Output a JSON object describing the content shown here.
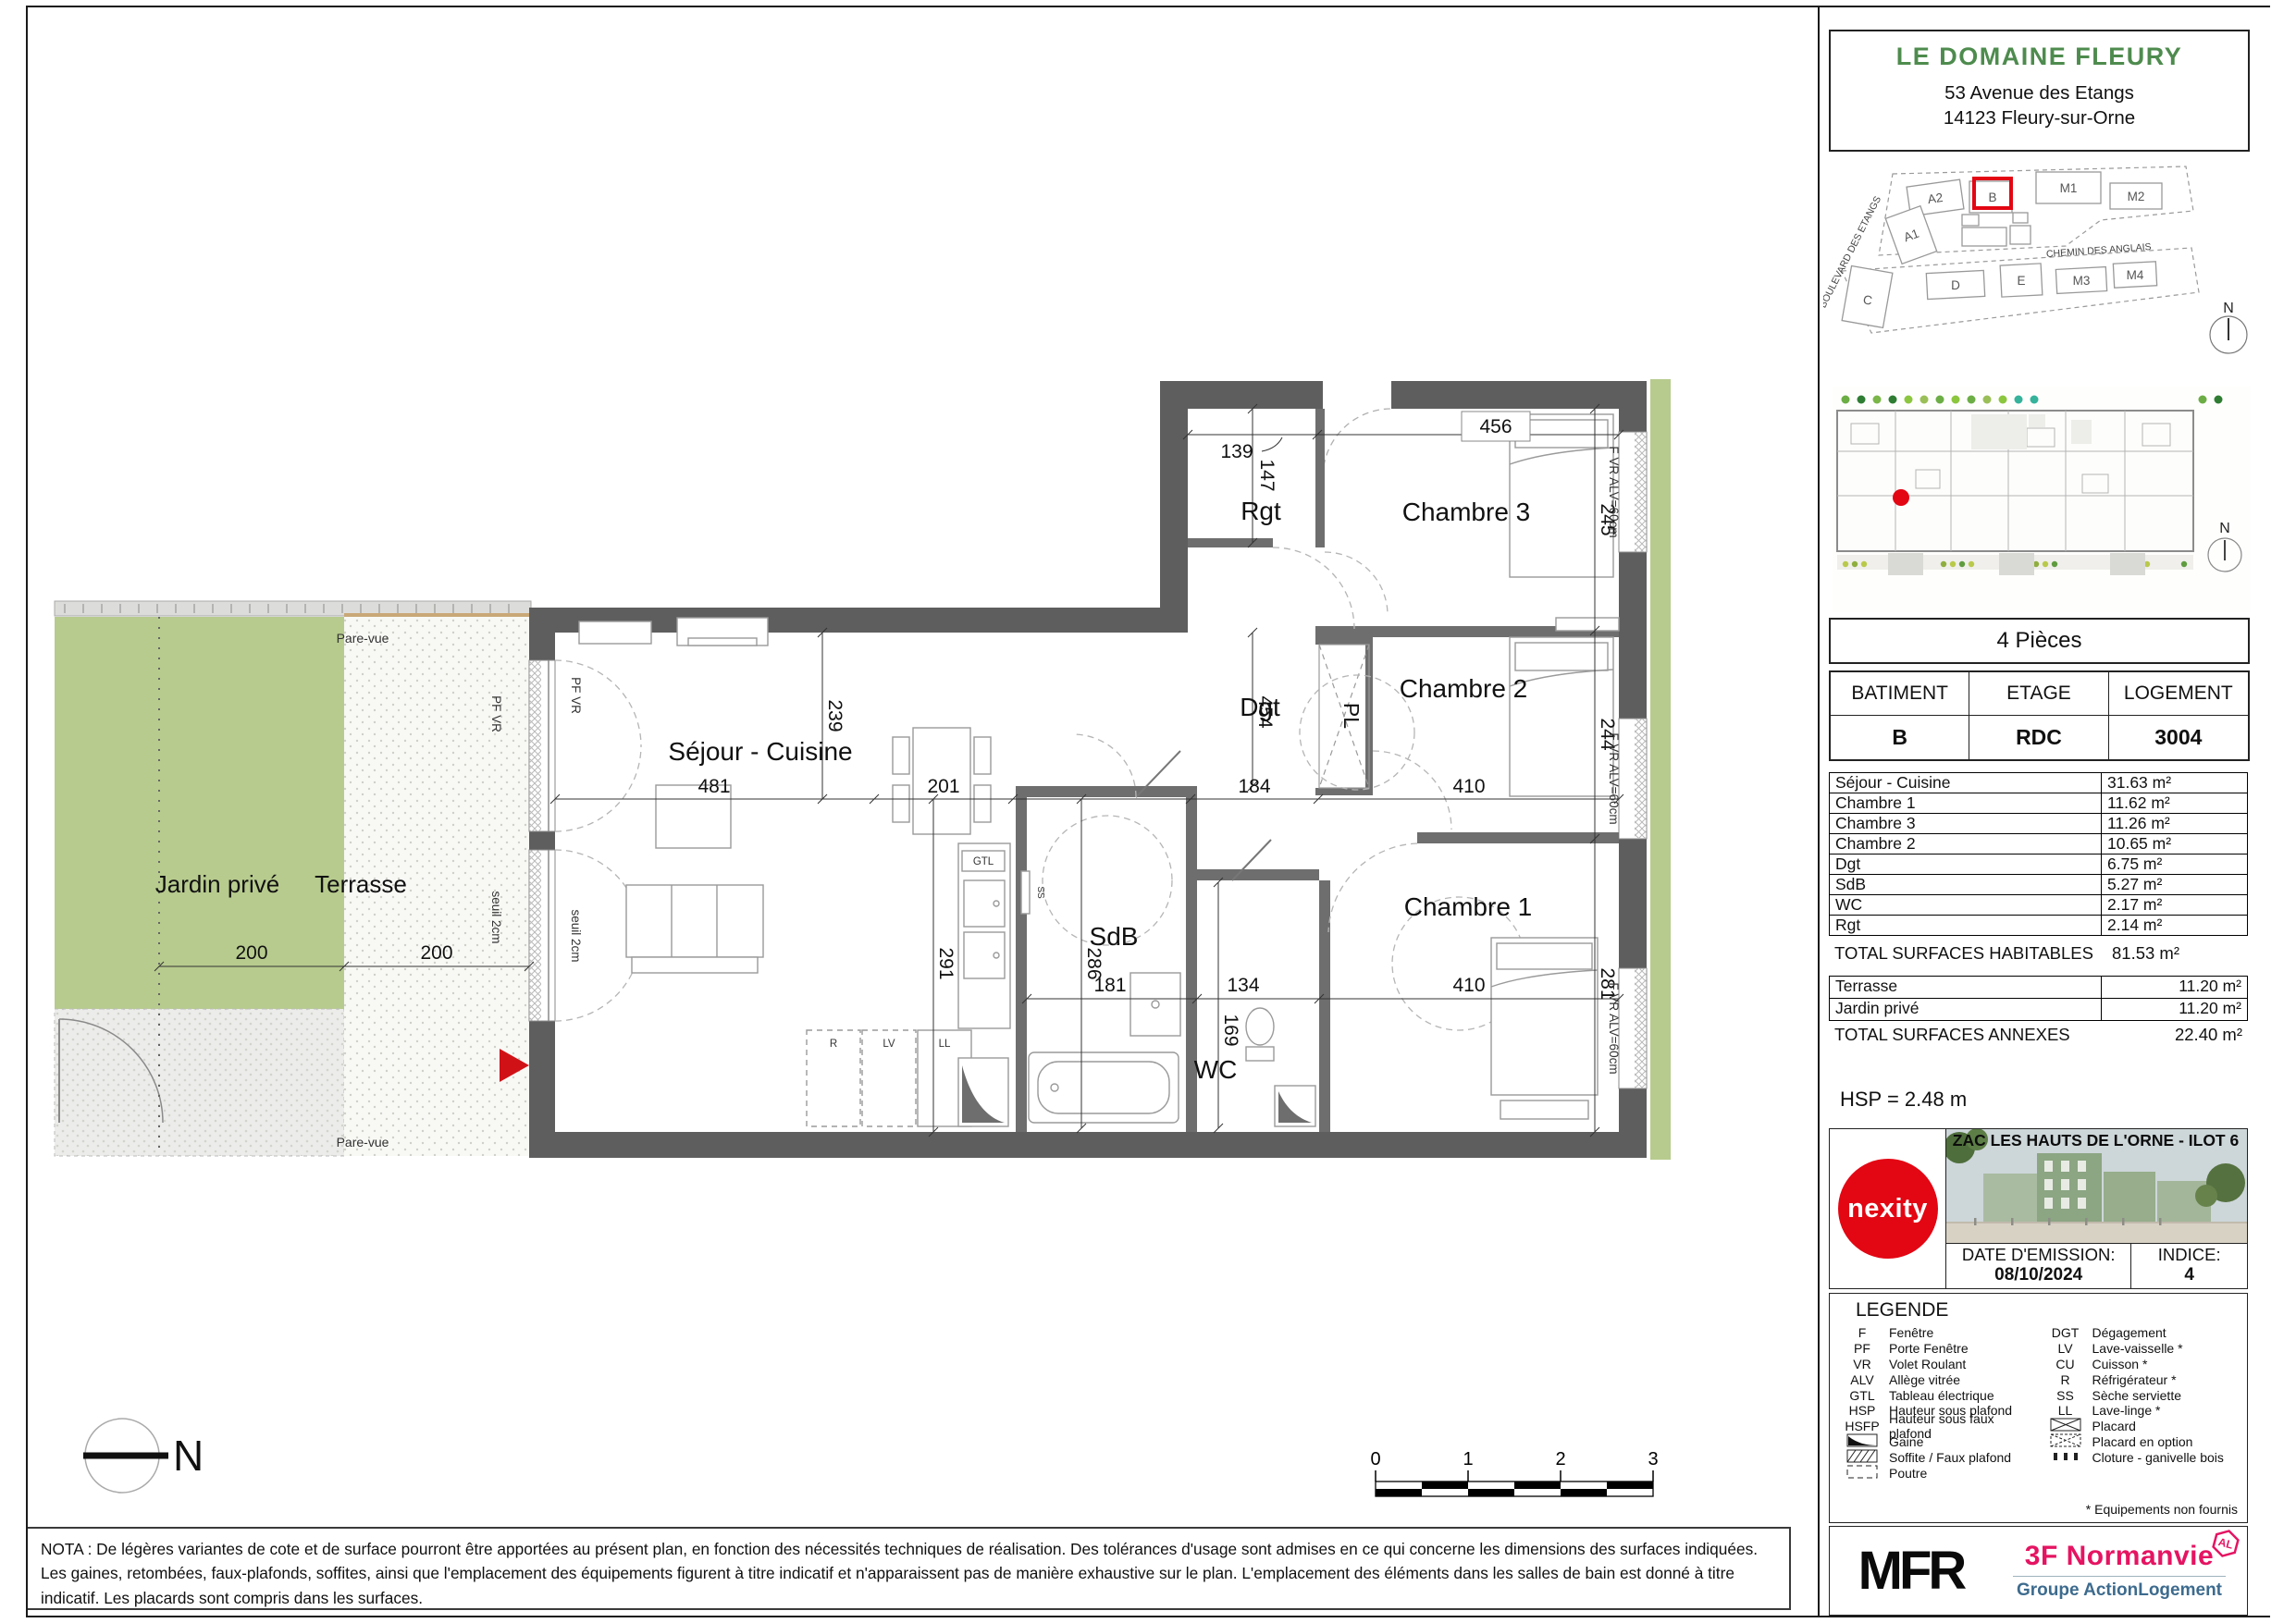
{
  "colors": {
    "title_green": "#4e8b4e",
    "nexity_red": "#e30613",
    "brand_pink": "#e51462",
    "group_blue": "#3d6b8e",
    "highlight_red": "#e30613",
    "garden_green": "#b7cb8e",
    "wall_gray": "#5e5e5e"
  },
  "header": {
    "title": "LE DOMAINE FLEURY",
    "address1": "53 Avenue des Etangs",
    "address2": "14123 Fleury-sur-Orne"
  },
  "site_plan": {
    "streets": {
      "s1": "BOULEVARD DES ETANGS",
      "s2": "CHEMIN DES ANGLAIS"
    },
    "buildings": {
      "a2": "A2",
      "a1": "A1",
      "b": "B",
      "m1": "M1",
      "m2": "M2",
      "c": "C",
      "d": "D",
      "e": "E",
      "m3": "M3",
      "m4": "M4"
    },
    "north": "N"
  },
  "masterplan": {
    "north": "N"
  },
  "unit": {
    "type": "4 Pièces",
    "cols": {
      "batiment": "BATIMENT",
      "etage": "ETAGE",
      "logement": "LOGEMENT"
    },
    "vals": {
      "batiment": "B",
      "etage": "RDC",
      "logement": "3004"
    }
  },
  "surfaces": {
    "rows": [
      {
        "label": "Séjour - Cuisine",
        "value": "31.63 m²"
      },
      {
        "label": "Chambre 1",
        "value": "11.62 m²"
      },
      {
        "label": "Chambre 3",
        "value": "11.26 m²"
      },
      {
        "label": "Chambre 2",
        "value": "10.65 m²"
      },
      {
        "label": "Dgt",
        "value": "6.75 m²"
      },
      {
        "label": "SdB",
        "value": "5.27 m²"
      },
      {
        "label": "WC",
        "value": "2.17 m²"
      },
      {
        "label": "Rgt",
        "value": "2.14 m²"
      }
    ],
    "total_label": "TOTAL SURFACES HABITABLES",
    "total_value": "81.53 m²"
  },
  "annexes": {
    "rows": [
      {
        "label": "Terrasse",
        "value": "11.20 m²"
      },
      {
        "label": "Jardin privé",
        "value": "11.20 m²"
      }
    ],
    "total_label": "TOTAL SURFACES ANNEXES",
    "total_value": "22.40 m²"
  },
  "hsp": "HSP = 2.48 m",
  "project": {
    "nexity": "nexity",
    "banner": "ZAC LES HAUTS DE L'ORNE - ILOT 6",
    "date_label": "DATE D'EMISSION:",
    "date_value": "08/10/2024",
    "indice_label": "INDICE:",
    "indice_value": "4"
  },
  "legend": {
    "title": "LEGENDE",
    "left": [
      {
        "abbr": "F",
        "label": "Fenêtre"
      },
      {
        "abbr": "PF",
        "label": "Porte Fenêtre"
      },
      {
        "abbr": "VR",
        "label": "Volet Roulant"
      },
      {
        "abbr": "ALV",
        "label": "Allège vitrée"
      },
      {
        "abbr": "GTL",
        "label": "Tableau électrique"
      },
      {
        "abbr": "HSP",
        "label": "Hauteur sous plafond"
      },
      {
        "abbr": "HSFP",
        "label": "Hauteur sous faux plafond"
      },
      {
        "abbr": "",
        "label": "Gaine"
      },
      {
        "abbr": "",
        "label": "Soffite / Faux plafond"
      },
      {
        "abbr": "",
        "label": "Poutre"
      }
    ],
    "right": [
      {
        "abbr": "DGT",
        "label": "Dégagement"
      },
      {
        "abbr": "LV",
        "label": "Lave-vaisselle *"
      },
      {
        "abbr": "CU",
        "label": "Cuisson *"
      },
      {
        "abbr": "R",
        "label": "Réfrigérateur *"
      },
      {
        "abbr": "SS",
        "label": "Sèche serviette"
      },
      {
        "abbr": "LL",
        "label": "Lave-linge *"
      },
      {
        "abbr": "",
        "label": "Placard"
      },
      {
        "abbr": "",
        "label": "Placard en option"
      },
      {
        "abbr": "",
        "label": "Cloture - ganivelle bois"
      }
    ],
    "footnote": "* Equipements non fournis"
  },
  "nota": "NOTA : De légères variantes de cote et de surface pourront être apportées au présent plan, en fonction des nécessités techniques de réalisation. Des tolérances d'usage sont admises en ce qui concerne les dimensions des surfaces indiquées. Les gaines, retombées, faux-plafonds, soffites,  ainsi que l'emplacement des équipements figurent à titre indicatif et n'apparaissent pas de manière exhaustive sur le plan. L'emplacement des éléments dans les salles de bain est donné à titre indicatif. Les placards sont compris dans les surfaces.",
  "logos": {
    "mfr": "MFR",
    "brand": "3F Normanvie",
    "badge": "AL",
    "group": "Groupe ActionLogement"
  },
  "plan": {
    "rooms": {
      "sejour": "Séjour - Cuisine",
      "rgt": "Rgt",
      "dgt": "Dgt",
      "pl": "PL",
      "ch3": "Chambre 3",
      "ch2": "Chambre 2",
      "ch1": "Chambre 1",
      "sdb": "SdB",
      "wc": "WC",
      "terrasse": "Terrasse",
      "jardin": "Jardin privé"
    },
    "dims": {
      "d456": "456",
      "d139": "139",
      "d147": "147",
      "d245": "245",
      "d244": "244",
      "d281": "281",
      "d239": "239",
      "d291": "291",
      "d454": "454",
      "d286": "286",
      "d169": "169",
      "d481": "481",
      "d201": "201",
      "d184": "184",
      "d410a": "410",
      "d181": "181",
      "d134": "134",
      "d410b": "410",
      "d200a": "200",
      "d200b": "200"
    },
    "labels": {
      "pare_vue_top": "Pare-vue",
      "pare_vue_bottom": "Pare-vue",
      "pf_vr_1": "PF VR",
      "pf_vr_2": "PF VR",
      "seuil_1": "seuil 2cm",
      "seuil_2": "seuil 2cm",
      "fvr_1": "F VR ALV=60cm",
      "fvr_2": "F VR ALV=60cm",
      "fvr_3": "F VR ALV=60cm",
      "gtl": "GTL",
      "r": "R",
      "lv": "LV",
      "ll": "LL",
      "ss": "SS"
    },
    "scale": {
      "n0": "0",
      "n1": "1",
      "n2": "2",
      "n3": "3"
    },
    "north": "N"
  }
}
